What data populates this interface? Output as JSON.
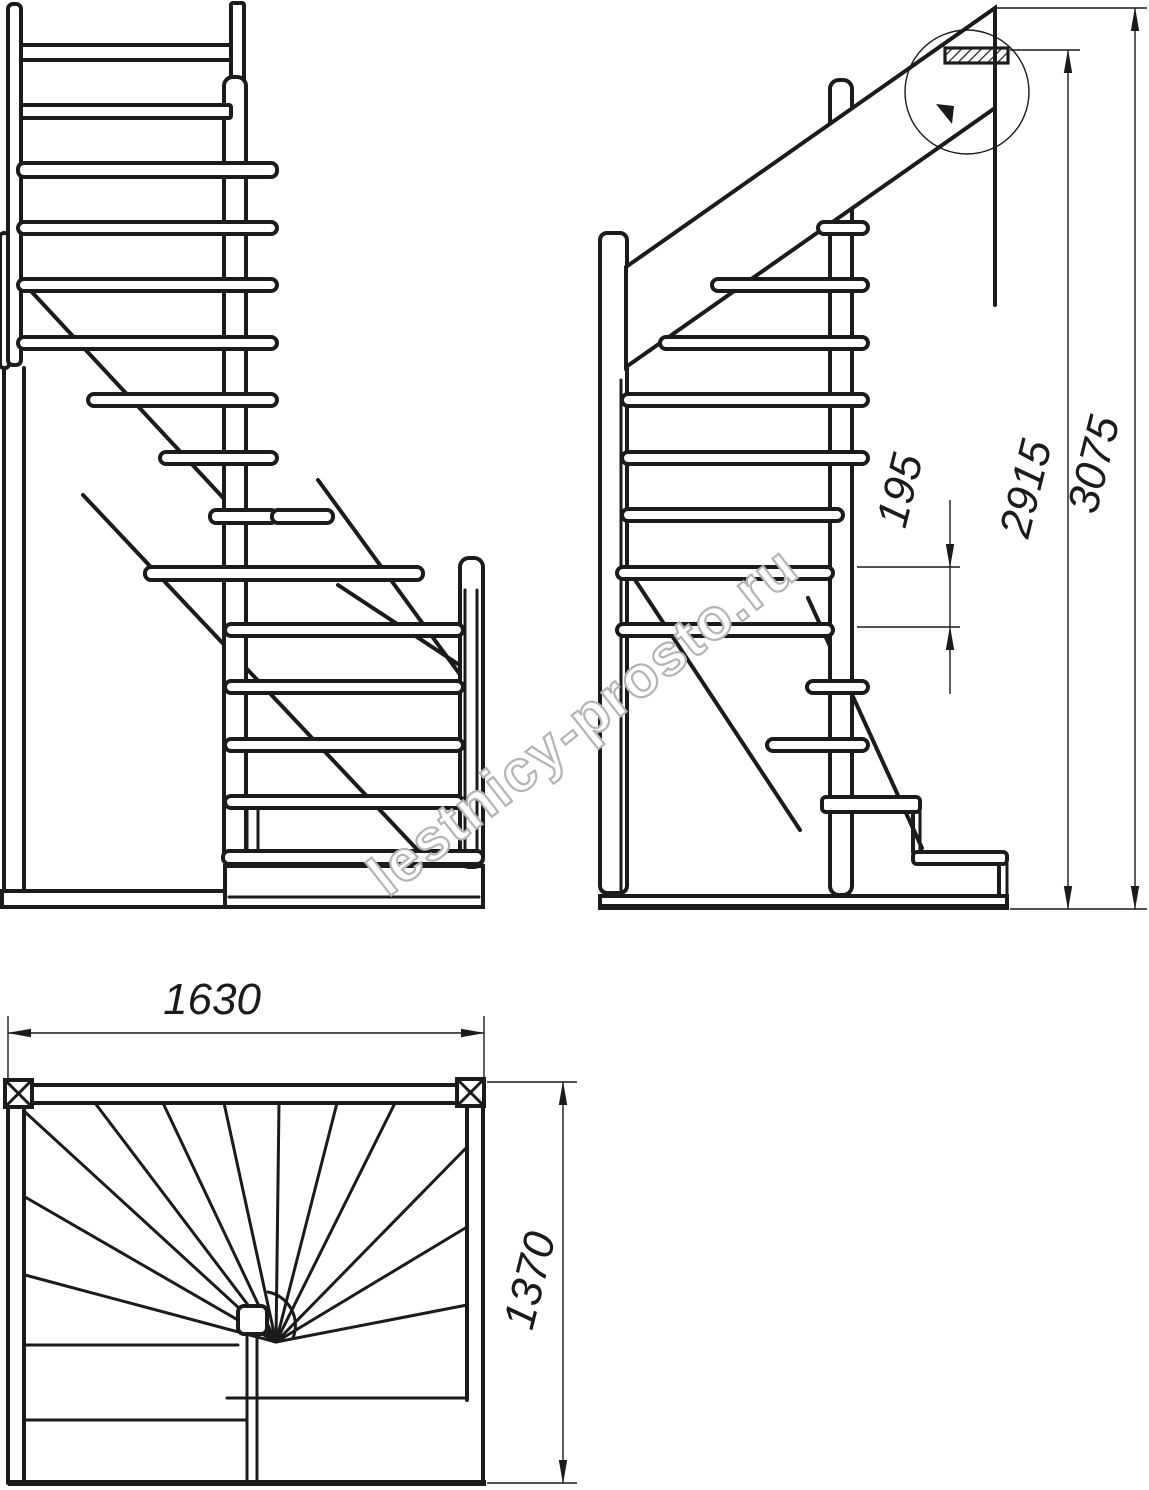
{
  "page": {
    "background": "#ffffff",
    "line_color": "#1b1b1b"
  },
  "watermark": {
    "text": "lestnicy-prosto.ru",
    "color": "#b4b4b4"
  },
  "dimensions": {
    "step_rise": "195",
    "height_to_landing": "2915",
    "total_height": "3075",
    "plan_width": "1630",
    "plan_depth": "1370"
  }
}
